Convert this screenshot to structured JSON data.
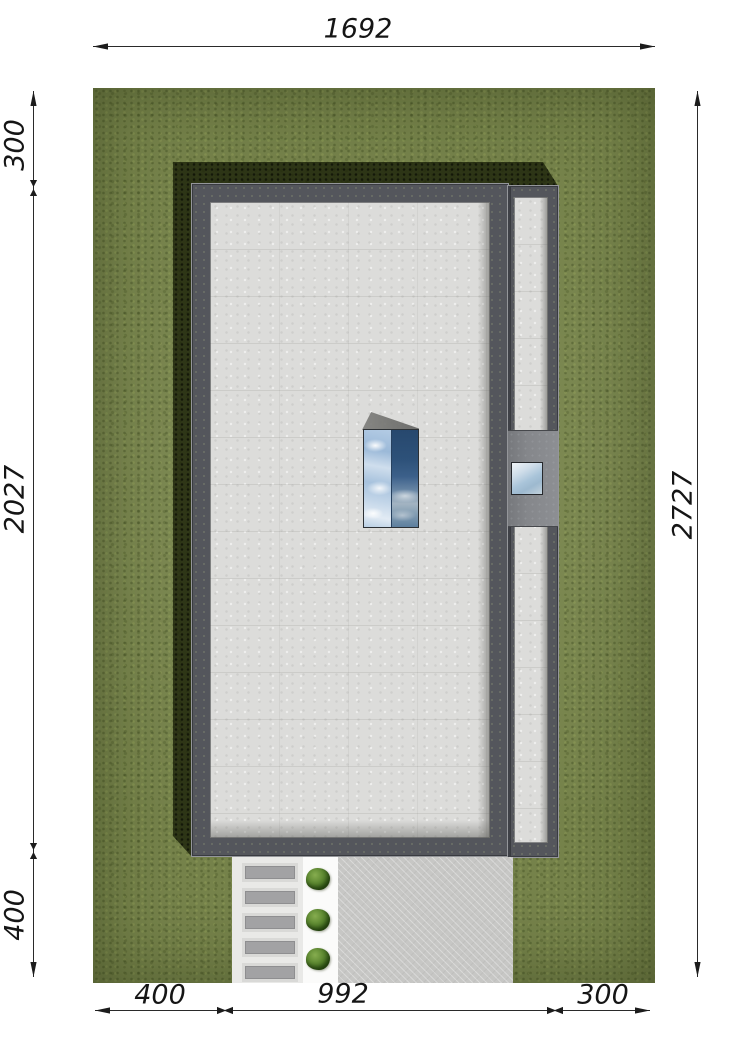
{
  "drawing": {
    "type": "architectural site plan, top view",
    "dimensions": {
      "top": {
        "value": "1692"
      },
      "left": [
        {
          "value": "300"
        },
        {
          "value": "2027"
        },
        {
          "value": "400"
        }
      ],
      "right": {
        "value": "2727"
      },
      "bottom": [
        {
          "value": "400"
        },
        {
          "value": "992"
        },
        {
          "value": "300"
        }
      ]
    },
    "palette": {
      "grass": "#75824A",
      "building_shadow": "#1C2209",
      "wall": "#54565C",
      "roof_membrane": "#DCDCDA",
      "driveway": "#C7C7C5",
      "walkway": "#E9E9E7",
      "garden_path": "#FBFBFA",
      "stepping_stone": "#A2A2A4",
      "bush": "#4E7A28",
      "skylight_sky_light": "#A6C3E0",
      "skylight_sky_dark": "#2C4E74",
      "annex_window_sky": "#B9CEDE",
      "dimension_text": "#151515"
    }
  }
}
